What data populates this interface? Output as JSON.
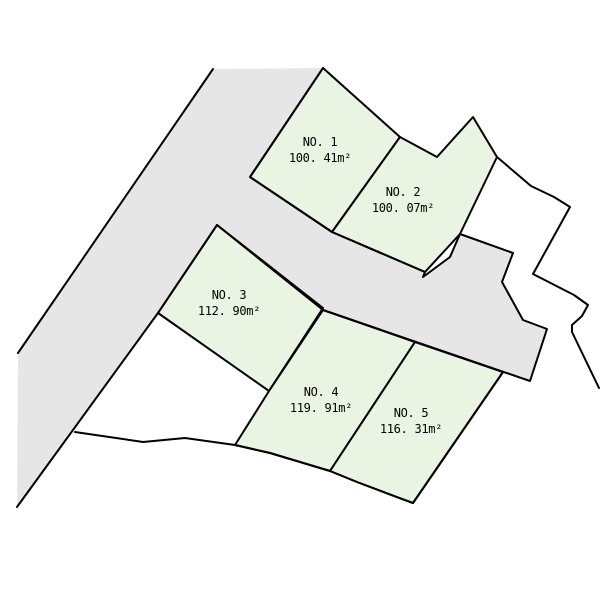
{
  "canvas": {
    "width": 600,
    "height": 600,
    "background": "#ffffff"
  },
  "colors": {
    "road_fill": "#e6e6e6",
    "lot_fill": "#e9f5e2",
    "line": "#000000",
    "label_text": "#000000"
  },
  "road": {
    "name": "road-area",
    "fill_polygon": [
      [
        213,
        69
      ],
      [
        323,
        68
      ],
      [
        250,
        177
      ],
      [
        332,
        232
      ],
      [
        425,
        272
      ],
      [
        423,
        277
      ],
      [
        450,
        257
      ],
      [
        460,
        234
      ],
      [
        513,
        253
      ],
      [
        502,
        282
      ],
      [
        523,
        320
      ],
      [
        547,
        329
      ],
      [
        530,
        381
      ],
      [
        323,
        310
      ],
      [
        217,
        225
      ],
      [
        158,
        313
      ],
      [
        17,
        507
      ],
      [
        18,
        353
      ]
    ],
    "stroke_path": [
      [
        323,
        68
      ],
      [
        250,
        177
      ],
      [
        332,
        232
      ],
      [
        425,
        272
      ],
      [
        423,
        277
      ],
      [
        450,
        257
      ],
      [
        460,
        234
      ],
      [
        513,
        253
      ],
      [
        502,
        282
      ],
      [
        523,
        320
      ],
      [
        547,
        329
      ],
      [
        530,
        381
      ],
      [
        323,
        310
      ],
      [
        217,
        225
      ],
      [
        158,
        313
      ],
      [
        17,
        507
      ]
    ]
  },
  "boundary_lines": [
    {
      "name": "road-left-edge",
      "points": [
        [
          213,
          69
        ],
        [
          18,
          353
        ]
      ]
    },
    {
      "name": "east-site-boundary",
      "points": [
        [
          497,
          157
        ],
        [
          531,
          186
        ],
        [
          554,
          197
        ],
        [
          570,
          207
        ],
        [
          533,
          274
        ],
        [
          574,
          295
        ],
        [
          588,
          305
        ],
        [
          582,
          316
        ],
        [
          572,
          325
        ],
        [
          572,
          332
        ],
        [
          599,
          388
        ]
      ]
    },
    {
      "name": "south-site-boundary",
      "points": [
        [
          75,
          432
        ],
        [
          143,
          442
        ],
        [
          185,
          438
        ],
        [
          235,
          445
        ],
        [
          270,
          453
        ],
        [
          330,
          471
        ],
        [
          357,
          482
        ],
        [
          402,
          499
        ],
        [
          413,
          503
        ]
      ]
    },
    {
      "name": "lot5-east-edge",
      "points": [
        [
          503,
          372
        ],
        [
          413,
          503
        ]
      ]
    }
  ],
  "lots": [
    {
      "id": "no1",
      "number_label": "NO. 1",
      "area_label": "100. 41m²",
      "label_x": 320,
      "label_y": 146,
      "polygon": [
        [
          323,
          68
        ],
        [
          400,
          137
        ],
        [
          332,
          232
        ],
        [
          250,
          177
        ]
      ]
    },
    {
      "id": "no2",
      "number_label": "NO. 2",
      "area_label": "100. 07m²",
      "label_x": 403,
      "label_y": 196,
      "polygon": [
        [
          400,
          137
        ],
        [
          437,
          157
        ],
        [
          473,
          117
        ],
        [
          497,
          157
        ],
        [
          460,
          234
        ],
        [
          425,
          272
        ],
        [
          332,
          232
        ]
      ]
    },
    {
      "id": "no3",
      "number_label": "NO. 3",
      "area_label": "112. 90m²",
      "label_x": 229,
      "label_y": 299,
      "polygon": [
        [
          217,
          225
        ],
        [
          323,
          308
        ],
        [
          269,
          391
        ],
        [
          158,
          313
        ]
      ]
    },
    {
      "id": "no4",
      "number_label": "NO. 4",
      "area_label": "119. 91m²",
      "label_x": 321,
      "label_y": 396,
      "polygon": [
        [
          323,
          310
        ],
        [
          415,
          342
        ],
        [
          330,
          471
        ],
        [
          270,
          453
        ],
        [
          235,
          445
        ],
        [
          269,
          391
        ]
      ]
    },
    {
      "id": "no5",
      "number_label": "NO. 5",
      "area_label": "116. 31m²",
      "label_x": 411,
      "label_y": 417,
      "polygon": [
        [
          415,
          342
        ],
        [
          503,
          372
        ],
        [
          413,
          503
        ],
        [
          402,
          499
        ],
        [
          357,
          482
        ],
        [
          330,
          471
        ]
      ]
    }
  ]
}
